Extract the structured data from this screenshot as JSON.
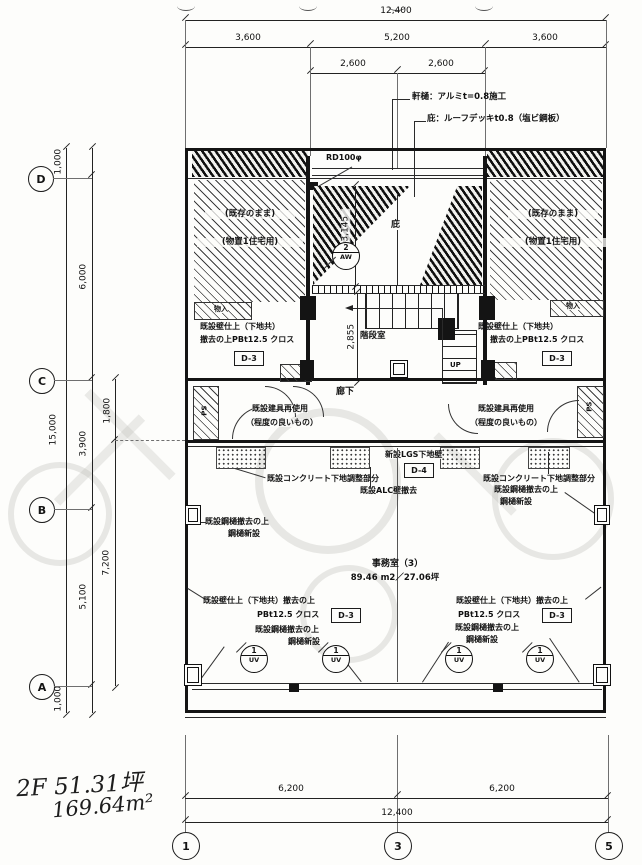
{
  "title": {
    "floor_area_tsubo": "2F 51.31坪",
    "floor_area_m2": "169.64m²"
  },
  "grid": {
    "row_d": "D",
    "row_c": "C",
    "row_b": "B",
    "row_a": "A",
    "col_1": "1",
    "col_3": "3",
    "col_5": "5"
  },
  "dims": {
    "top_overall": "12,400",
    "top_left": "3,600",
    "top_center": "5,200",
    "top_right": "3,600",
    "top_sub_left": "2,600",
    "top_sub_right": "2,600",
    "left_overall": "15,000",
    "left_1000_top": "1,000",
    "left_6000": "6,000",
    "left_3900": "3,900",
    "left_5100": "5,100",
    "left_1800": "1,800",
    "left_7200": "7,200",
    "left_1000_bottom": "1,000",
    "bottom_left": "6,200",
    "bottom_right": "6,200",
    "bottom_overall": "12,400",
    "canopy_3145": "3,145",
    "stair_2855": "2,855"
  },
  "notes": {
    "eaves_gutter": "軒樋：アルミt=0.8施工",
    "canopy_spec": "庇：ルーフデッキt0.8（塩ビ鋼板）",
    "roof_drain": "RD100φ",
    "canopy_label": "庇",
    "existing_1": "(既存のまま)",
    "existing_2": "(物置1住宅用)",
    "wall_finish_a": "既設壁仕上（下地共）",
    "wall_finish_b": "撤去の上PBt12.5 クロス",
    "wall_finish_c": "既設壁仕上（下地共）撤去の上",
    "wall_finish_d": "PBt12.5 クロス",
    "d3": "D-3",
    "d4": "D-4",
    "door_reuse_1": "既設建具再使用",
    "door_reuse_2": "（程度の良いもの）",
    "corridor": "廊下",
    "stair": "階段室",
    "up": "UP",
    "closet": "物入",
    "ps": "PS",
    "lgs_wall": "新設LGS下地壁",
    "concrete": "既設コンクリート下地調整部分",
    "alc": "既設ALC壁撤去",
    "gutter_1": "既設鋼樋撤去の上",
    "gutter_2": "鋼樋新設",
    "office_name": "事務室（3）",
    "office_area": "89.46 m2／27.06坪"
  },
  "markers": {
    "aw_no": "2",
    "aw_code": "AW",
    "uv_no": "1",
    "uv_code": "UV"
  }
}
